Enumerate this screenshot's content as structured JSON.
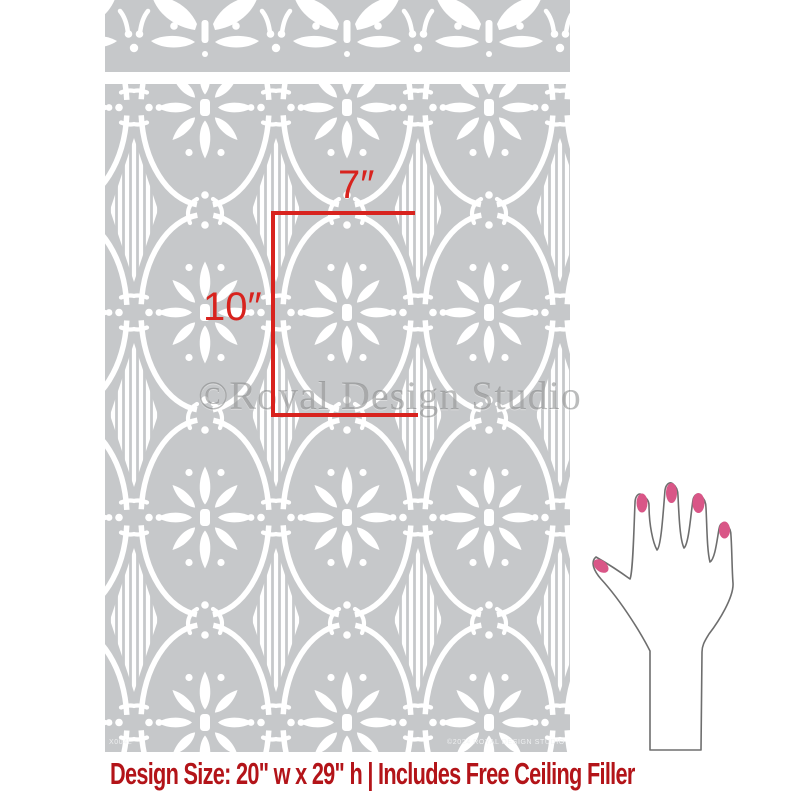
{
  "product_image": {
    "type_note": "wall stencil product image",
    "stencil": {
      "base_color": "#c6c8ca",
      "cut_color": "#ffffff",
      "border_strip_motif": "lotus-fan-and-comma-scroll-border",
      "main_panel_motif": "oval-lattice-with-8-petal-flowers-and-striped-diamonds",
      "product_code": "X004L",
      "copyright_note": "©2024 ROYAL DESIGN STUDIO"
    },
    "watermark": "©Royal Design Studio",
    "dimensions": {
      "width_label": "7″",
      "height_label": "10″",
      "line_color": "#d8231e"
    },
    "hand": {
      "nail_color": "#d95687",
      "outline_color": "#6e6e6e"
    },
    "caption": {
      "text": "Design Size: 20\" w x 29\" h | Includes Free Ceiling Filler",
      "color": "#b31419"
    }
  }
}
